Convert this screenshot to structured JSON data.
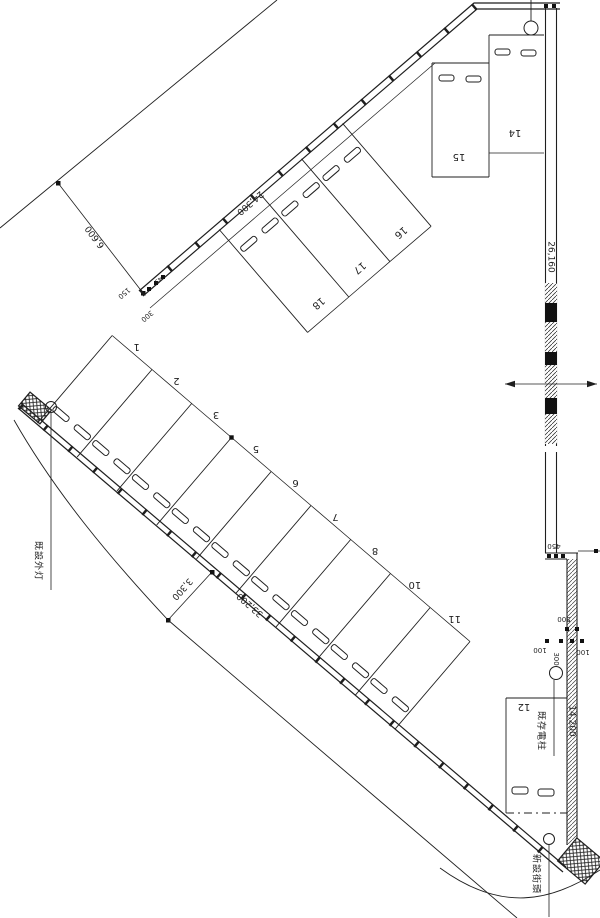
{
  "drawing": {
    "labels": {
      "existing_light": "既設外灯",
      "existing_pole": "既存電柱",
      "new_light": "新設街頭"
    },
    "dims": {
      "d6600": "6,600",
      "d24300": "24,300",
      "d150": "150",
      "d300_top": "300",
      "d45": "45",
      "d26160": "26,160",
      "d450": "450",
      "d500": "500",
      "d100_left": "100",
      "d100_right": "100",
      "d300_right": "300",
      "d14200": "14,200",
      "d33200": "33,200",
      "d3300": "3,300"
    },
    "stalls": {
      "diagonal_row": [
        "1",
        "2",
        "3",
        "5",
        "6",
        "7",
        "8",
        "10",
        "11"
      ],
      "top_row": [
        "18",
        "17",
        "16"
      ],
      "top_right": [
        "15",
        "14"
      ],
      "bottom_right": [
        "12"
      ]
    },
    "colors": {
      "line": "#1f1f1f",
      "paper": "#ffffff"
    }
  }
}
